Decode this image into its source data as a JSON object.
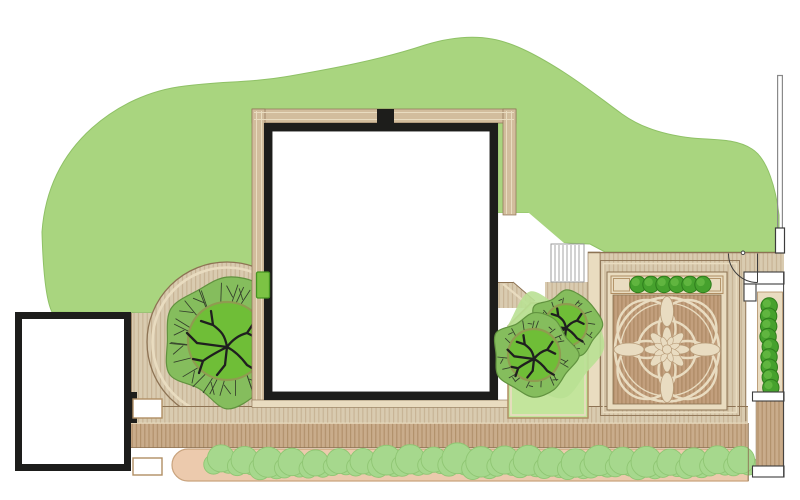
{
  "title": "Garden landscape design plan (top view)",
  "canvas": {
    "width": 800,
    "height": 500
  },
  "legend": {
    "lawn": "Lawn",
    "house": "House (main building)",
    "garage": "Garage / outbuilding",
    "decking": "Timber decking and paths",
    "parterre_panel": "Ornamental parterre deck panel",
    "steps": "Garden steps",
    "hedge_row": "Clipped hedge row along lower path",
    "parterre_planter": "Raised planter with clipped shrubs",
    "side_hedge": "Side passage hedge",
    "trees": "Trees (branch plan symbols)",
    "gate": "Gate with door-swing symbol",
    "fence": "Boundary fence"
  },
  "planting": {
    "hedge_row": {
      "bush_count": 23
    },
    "parterre_planter": {
      "bush_count": 6
    },
    "side_hedge": {
      "bush_count": 9
    },
    "trees": {
      "count": 3
    }
  },
  "stairs": {
    "tread_count": 7
  },
  "colors": {
    "paper": "#ffffff",
    "lawn": "#a9d57f",
    "lawn_edge": "#8fc166",
    "wall": "#1d1d1b",
    "deck_light": "#d9cbb0",
    "deck_light_stripe": "#c6b293",
    "deck_mid": "#c9ac8b",
    "deck_mid_stripe": "#b2916c",
    "parterre_bg": "#c29f7d",
    "parterre_stripe": "#ad8a64",
    "edging_cream": "#e9dcc0",
    "edging_line": "#8d7354",
    "edging_mid": "#b08e63",
    "house_band": "#d2bd9d",
    "ornament_fill": "#e9dcc1",
    "ornament_line": "#b89c79",
    "bush_dark": "#46a12d",
    "bush_dark_edge": "#2e7c1c",
    "bush_dark_hi": "#6abc45",
    "bush_light": "#a6d88d",
    "bush_light_edge": "#8fc673",
    "hedge_bed": "#eccaad",
    "hedge_bed_edge": "#c9a37d",
    "tree_canopy": "#85bd5d",
    "tree_canopy_edge": "#61923f",
    "tree_inner": "#6fbe37",
    "trunk_ring": "#8f9b50",
    "branch": "#1f1f1f",
    "bed_green": "#c3e59c",
    "bed_splash": "#b9e093",
    "planter_green": "#7cc344",
    "planter_green_edge": "#459421",
    "stair_line": "#9b9b9b",
    "fence_line": "#8a8a8a",
    "structure_line": "#3c3c3c"
  }
}
